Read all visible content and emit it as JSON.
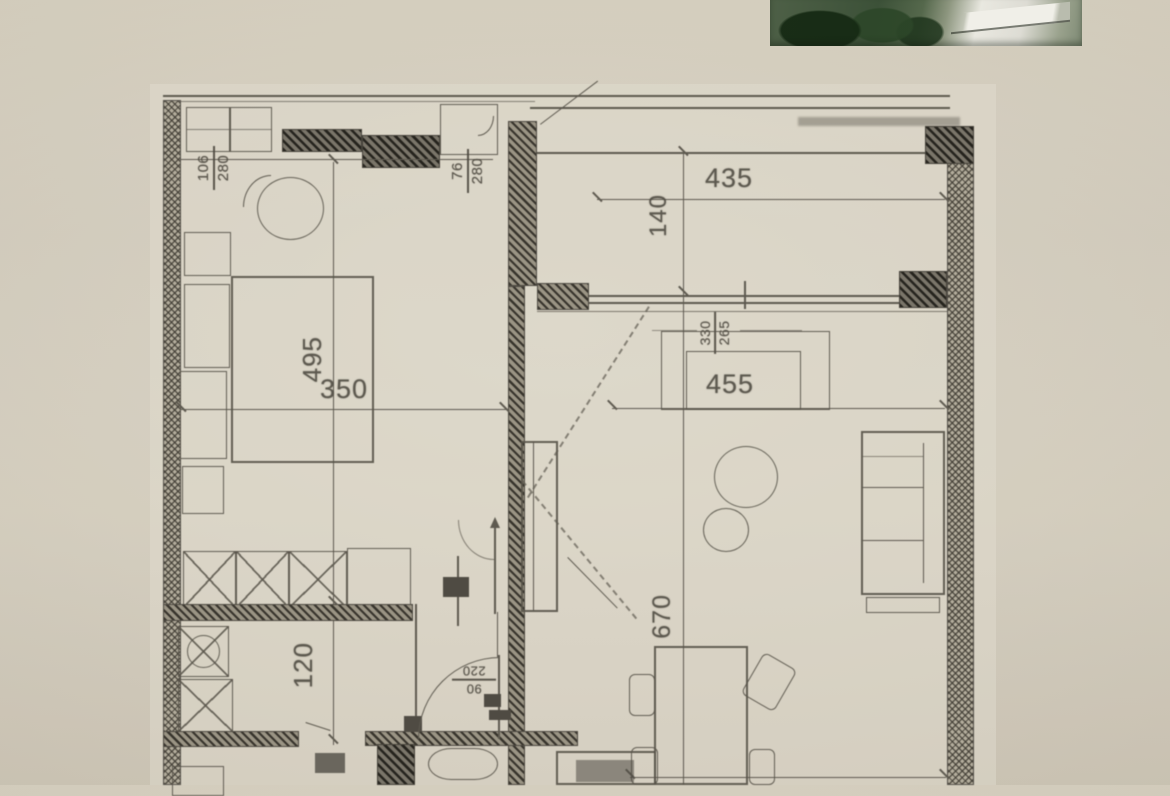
{
  "photo_inset": {
    "alt": "greenery and white building fragment"
  },
  "dimensions": {
    "balcony_width": "435",
    "balcony_depth": "140",
    "living_width": "455",
    "living_length": "670",
    "bedroom_length": "495",
    "bedroom_width": "350",
    "hall_width": "120",
    "niche": {
      "w": "330",
      "h": "265"
    },
    "window_bedroom": {
      "w": "106",
      "h": "280"
    },
    "window_hall": {
      "w": "76",
      "h": "280"
    },
    "door_entry": {
      "w": "90",
      "h": "220"
    }
  }
}
